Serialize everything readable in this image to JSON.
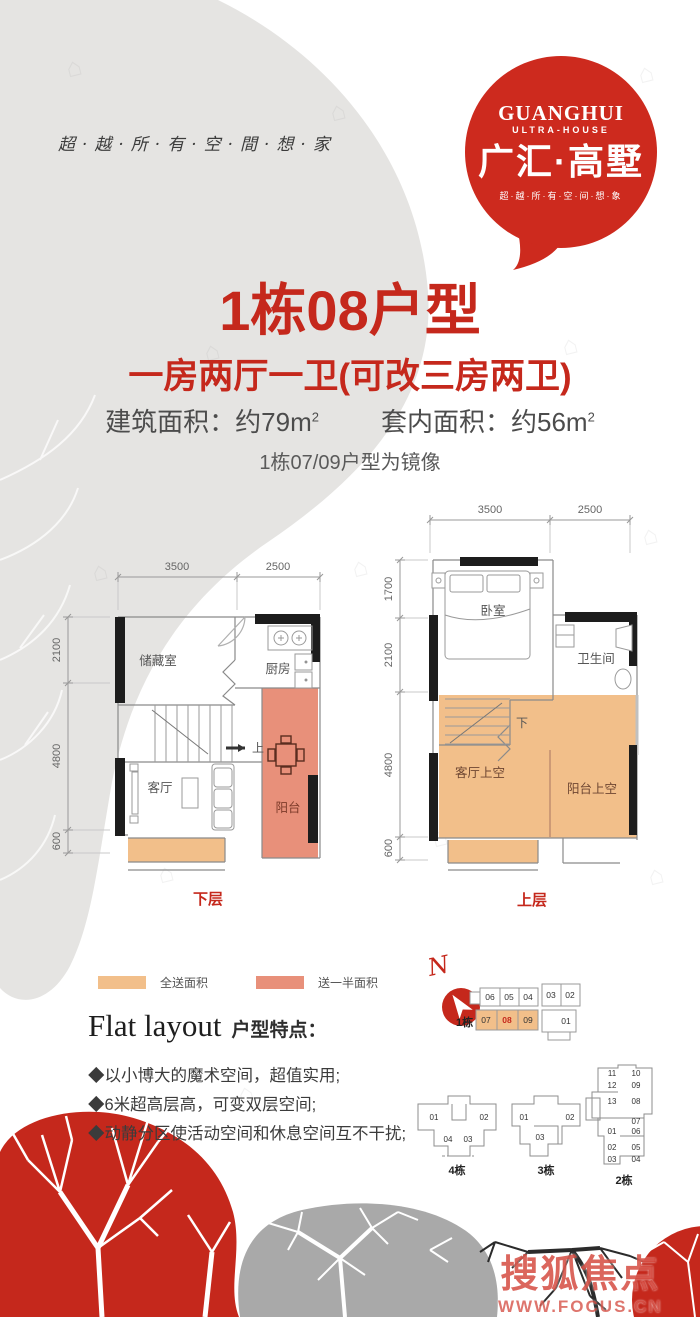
{
  "brand": {
    "en_name": "GUANGHUI",
    "en_sub": "ULTRA-HOUSE",
    "cn_name": "广汇·高墅",
    "tagline": "超·越·所·有·空·间·想·象",
    "side_slogan": "超·越·所·有·空·間·想·家"
  },
  "header": {
    "title": "1栋08户型",
    "subtitle": "一房两厅一卫(可改三房两卫)",
    "built_area_label": "建筑面积：约79m",
    "built_area_sup": "2",
    "inner_area_label": "套内面积：约56m",
    "inner_area_sup": "2",
    "mirror_note": "1栋07/09户型为镜像"
  },
  "lower_plan": {
    "floor_label": "下层",
    "dim_top_1": "3500",
    "dim_top_2": "2500",
    "dim_left_1": "2100",
    "dim_left_2": "4800",
    "dim_left_3": "600",
    "room_storage": "储藏室",
    "room_kitchen": "厨房",
    "room_living": "客厅",
    "room_balcony": "阳台",
    "stairs_label": "上"
  },
  "upper_plan": {
    "floor_label": "上层",
    "dim_top_1": "3500",
    "dim_top_2": "2500",
    "dim_left_1": "1700",
    "dim_left_2": "2100",
    "dim_left_3": "4800",
    "dim_left_4": "600",
    "room_bedroom": "卧室",
    "room_bathroom": "卫生间",
    "room_living_void": "客厅上空",
    "room_balcony_void": "阳台上空",
    "stairs_label": "下"
  },
  "legend": {
    "full_label": "全送面积",
    "half_label": "送一半面积",
    "full_color": "#f2bf8a",
    "half_color": "#e8907a"
  },
  "features": {
    "title_en": "Flat layout",
    "title_cn": "户型特点：",
    "item_1": "◆以小博大的魔术空间，超值实用;",
    "item_2": "◆6米超高层高，可变双层空间;",
    "item_3": "◆动静分区使活动空间和休息空间互不干扰;"
  },
  "compass": {
    "north": "N"
  },
  "site": {
    "b1_label": "1栋",
    "b1_top": [
      "06",
      "05",
      "04",
      "03",
      "02"
    ],
    "b1_bottom": [
      "07",
      "08",
      "09",
      "01"
    ],
    "b4_label": "4栋",
    "b4_units": [
      "01",
      "02",
      "04",
      "03"
    ],
    "b3_label": "3栋",
    "b3_units": [
      "01",
      "02",
      "03"
    ],
    "b2_label": "2栋",
    "b2_units": [
      "11",
      "10",
      "12",
      "09",
      "13",
      "08",
      "07",
      "01",
      "06",
      "02",
      "05",
      "03",
      "04"
    ]
  },
  "watermark": {
    "name": "搜狐焦点",
    "url": "WWW.FOCUS.CN",
    "house_glyph": "⌂"
  },
  "colors": {
    "accent": "#c5281c",
    "plan_orange": "#f2bf8a",
    "plan_salmon": "#e8907a"
  }
}
